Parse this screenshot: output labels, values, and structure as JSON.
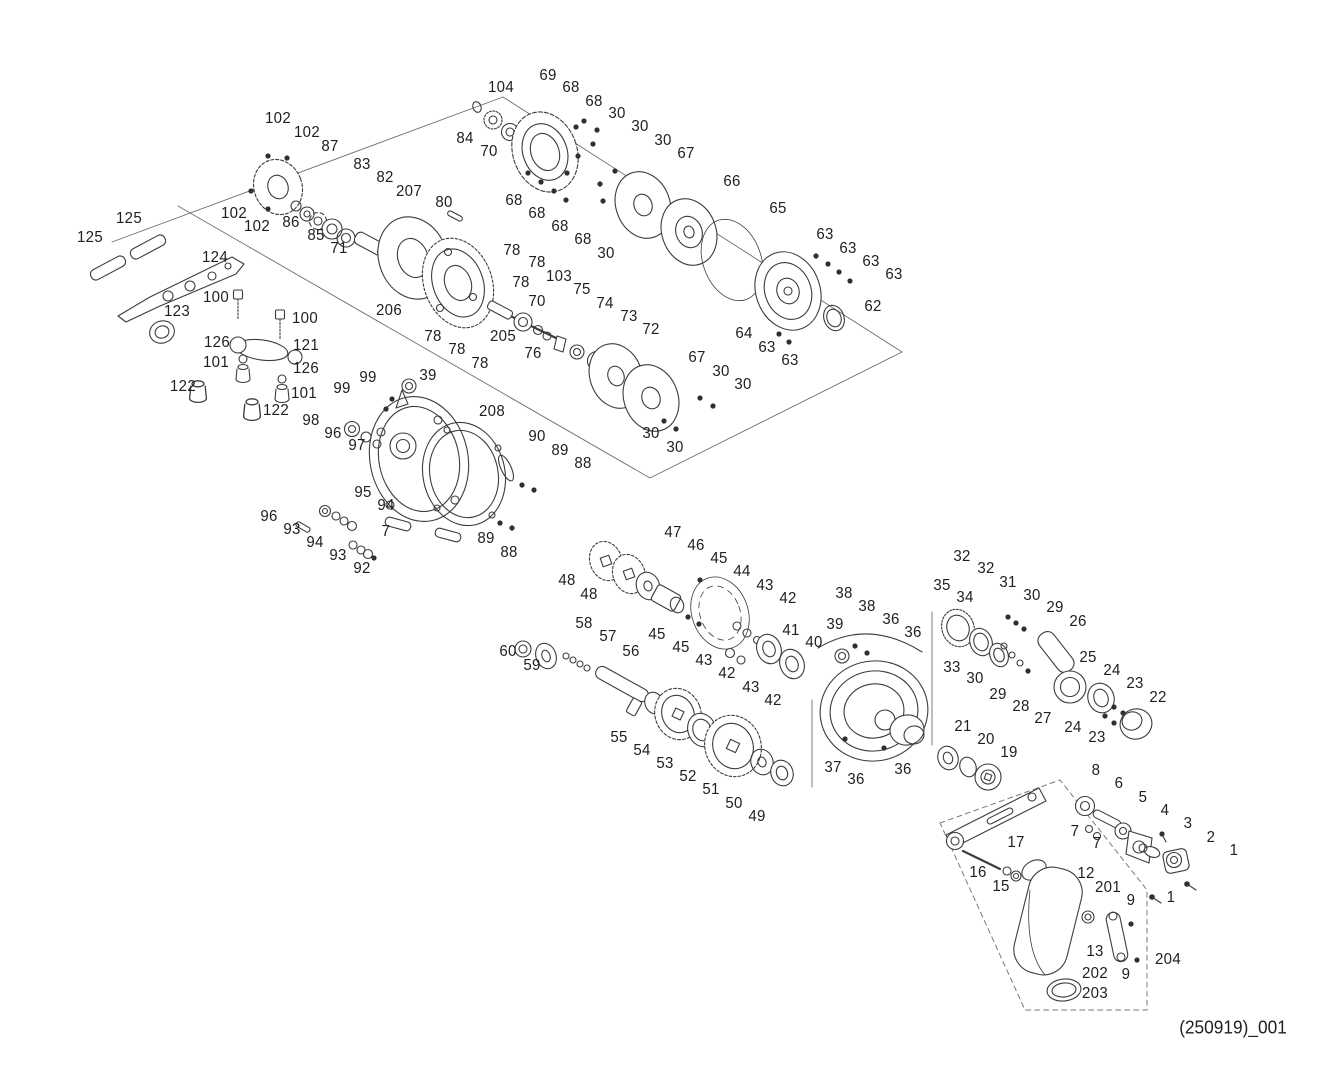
{
  "page": {
    "background": "#ffffff",
    "ink_color": "#1f1f1f"
  },
  "footer": {
    "doc_code": "(250919)_001",
    "x": 1233,
    "y": 1028
  },
  "diagram": {
    "kind": "exploded-parts-schematic",
    "labels": [
      [
        "102",
        278,
        119
      ],
      [
        "102",
        307,
        133
      ],
      [
        "87",
        330,
        147
      ],
      [
        "83",
        362,
        165
      ],
      [
        "82",
        385,
        178
      ],
      [
        "207",
        409,
        192
      ],
      [
        "80",
        444,
        203
      ],
      [
        "102",
        234,
        214
      ],
      [
        "102",
        257,
        227
      ],
      [
        "86",
        291,
        223
      ],
      [
        "85",
        316,
        236
      ],
      [
        "71",
        339,
        249
      ],
      [
        "125",
        129,
        219
      ],
      [
        "125",
        90,
        238
      ],
      [
        "124",
        215,
        258
      ],
      [
        "123",
        177,
        312
      ],
      [
        "100",
        216,
        298
      ],
      [
        "100",
        305,
        319
      ],
      [
        "206",
        389,
        311
      ],
      [
        "126",
        217,
        343
      ],
      [
        "121",
        306,
        346
      ],
      [
        "101",
        216,
        363
      ],
      [
        "126",
        306,
        369
      ],
      [
        "122",
        183,
        387
      ],
      [
        "101",
        304,
        394
      ],
      [
        "122",
        276,
        411
      ],
      [
        "104",
        501,
        88
      ],
      [
        "69",
        548,
        76
      ],
      [
        "68",
        571,
        88
      ],
      [
        "68",
        594,
        102
      ],
      [
        "30",
        617,
        114
      ],
      [
        "30",
        640,
        127
      ],
      [
        "30",
        663,
        141
      ],
      [
        "67",
        686,
        154
      ],
      [
        "66",
        732,
        182
      ],
      [
        "84",
        465,
        139
      ],
      [
        "70",
        489,
        152
      ],
      [
        "68",
        514,
        201
      ],
      [
        "68",
        537,
        214
      ],
      [
        "68",
        560,
        227
      ],
      [
        "68",
        583,
        240
      ],
      [
        "30",
        606,
        254
      ],
      [
        "65",
        778,
        209
      ],
      [
        "63",
        825,
        235
      ],
      [
        "63",
        848,
        249
      ],
      [
        "63",
        871,
        262
      ],
      [
        "63",
        894,
        275
      ],
      [
        "62",
        873,
        307
      ],
      [
        "64",
        744,
        334
      ],
      [
        "63",
        767,
        348
      ],
      [
        "63",
        790,
        361
      ],
      [
        "78",
        512,
        251
      ],
      [
        "78",
        537,
        263
      ],
      [
        "78",
        521,
        283
      ],
      [
        "103",
        559,
        277
      ],
      [
        "70",
        537,
        302
      ],
      [
        "75",
        582,
        290
      ],
      [
        "74",
        605,
        304
      ],
      [
        "73",
        629,
        317
      ],
      [
        "72",
        651,
        330
      ],
      [
        "205",
        503,
        337
      ],
      [
        "76",
        533,
        354
      ],
      [
        "78",
        433,
        337
      ],
      [
        "78",
        457,
        350
      ],
      [
        "78",
        480,
        364
      ],
      [
        "67",
        697,
        358
      ],
      [
        "30",
        721,
        372
      ],
      [
        "30",
        743,
        385
      ],
      [
        "30",
        651,
        434
      ],
      [
        "30",
        675,
        448
      ],
      [
        "39",
        428,
        376
      ],
      [
        "99",
        368,
        378
      ],
      [
        "99",
        342,
        389
      ],
      [
        "98",
        311,
        421
      ],
      [
        "96",
        333,
        434
      ],
      [
        "97",
        357,
        446
      ],
      [
        "208",
        492,
        412
      ],
      [
        "90",
        537,
        437
      ],
      [
        "89",
        560,
        451
      ],
      [
        "88",
        583,
        464
      ],
      [
        "95",
        363,
        493
      ],
      [
        "94",
        386,
        506
      ],
      [
        "96",
        269,
        517
      ],
      [
        "93",
        292,
        530
      ],
      [
        "94",
        315,
        543
      ],
      [
        "93",
        338,
        556
      ],
      [
        "7",
        386,
        532
      ],
      [
        "92",
        362,
        569
      ],
      [
        "89",
        486,
        539
      ],
      [
        "88",
        509,
        553
      ],
      [
        "47",
        673,
        533
      ],
      [
        "46",
        696,
        546
      ],
      [
        "45",
        719,
        559
      ],
      [
        "44",
        742,
        572
      ],
      [
        "43",
        765,
        586
      ],
      [
        "42",
        788,
        599
      ],
      [
        "48",
        567,
        581
      ],
      [
        "48",
        589,
        595
      ],
      [
        "58",
        584,
        624
      ],
      [
        "57",
        608,
        637
      ],
      [
        "56",
        631,
        652
      ],
      [
        "45",
        657,
        635
      ],
      [
        "45",
        681,
        648
      ],
      [
        "43",
        704,
        661
      ],
      [
        "42",
        727,
        674
      ],
      [
        "43",
        751,
        688
      ],
      [
        "42",
        773,
        701
      ],
      [
        "41",
        791,
        631
      ],
      [
        "40",
        814,
        643
      ],
      [
        "60",
        508,
        652
      ],
      [
        "59",
        532,
        666
      ],
      [
        "55",
        619,
        738
      ],
      [
        "54",
        642,
        751
      ],
      [
        "53",
        665,
        764
      ],
      [
        "52",
        688,
        777
      ],
      [
        "51",
        711,
        790
      ],
      [
        "50",
        734,
        804
      ],
      [
        "49",
        757,
        817
      ],
      [
        "32",
        962,
        557
      ],
      [
        "32",
        986,
        569
      ],
      [
        "31",
        1008,
        583
      ],
      [
        "30",
        1032,
        596
      ],
      [
        "29",
        1055,
        608
      ],
      [
        "26",
        1078,
        622
      ],
      [
        "35",
        942,
        586
      ],
      [
        "34",
        965,
        598
      ],
      [
        "38",
        844,
        594
      ],
      [
        "38",
        867,
        607
      ],
      [
        "36",
        891,
        620
      ],
      [
        "36",
        913,
        633
      ],
      [
        "39",
        835,
        625
      ],
      [
        "33",
        952,
        668
      ],
      [
        "30",
        975,
        679
      ],
      [
        "29",
        998,
        695
      ],
      [
        "28",
        1021,
        707
      ],
      [
        "27",
        1043,
        719
      ],
      [
        "25",
        1088,
        658
      ],
      [
        "24",
        1112,
        671
      ],
      [
        "23",
        1135,
        684
      ],
      [
        "22",
        1158,
        698
      ],
      [
        "24",
        1073,
        728
      ],
      [
        "23",
        1097,
        738
      ],
      [
        "21",
        963,
        727
      ],
      [
        "20",
        986,
        740
      ],
      [
        "19",
        1009,
        753
      ],
      [
        "37",
        833,
        768
      ],
      [
        "36",
        856,
        780
      ],
      [
        "36",
        903,
        770
      ],
      [
        "8",
        1096,
        771
      ],
      [
        "6",
        1119,
        784
      ],
      [
        "5",
        1143,
        798
      ],
      [
        "4",
        1165,
        811
      ],
      [
        "3",
        1188,
        824
      ],
      [
        "2",
        1211,
        838
      ],
      [
        "1",
        1234,
        851
      ],
      [
        "7",
        1075,
        832
      ],
      [
        "7",
        1097,
        844
      ],
      [
        "17",
        1016,
        843
      ],
      [
        "16",
        978,
        873
      ],
      [
        "15",
        1001,
        887
      ],
      [
        "12",
        1086,
        874
      ],
      [
        "201",
        1108,
        888
      ],
      [
        "9",
        1131,
        901
      ],
      [
        "1",
        1171,
        898
      ],
      [
        "13",
        1095,
        952
      ],
      [
        "202",
        1095,
        974
      ],
      [
        "9",
        1126,
        975
      ],
      [
        "204",
        1168,
        960
      ],
      [
        "203",
        1095,
        994
      ]
    ]
  }
}
